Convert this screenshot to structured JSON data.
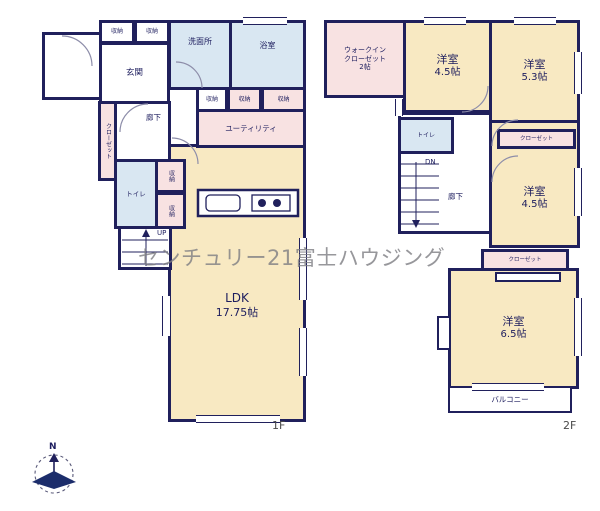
{
  "watermark": "センチュリー21富士ハウジング",
  "compass": {
    "north_label": "N"
  },
  "floor1": {
    "floor_label": "1F",
    "genkan": "玄関",
    "storage_a": "収納",
    "storage_b": "収納",
    "washroom": "洗面所",
    "bathroom": "浴室",
    "storage_c": "収納",
    "storage_d": "収納",
    "storage_e": "収納",
    "utility": "ユーティリティ",
    "closet": "クローゼット",
    "hallway": "廊下",
    "toilet": "トイレ",
    "storage_f": "収納",
    "storage_g": "収納",
    "stairs_up": "UP",
    "ldk_name": "LDK",
    "ldk_size": "17.75帖"
  },
  "floor2": {
    "floor_label": "2F",
    "wic_line1": "ウォークイン",
    "wic_line2": "クローゼット",
    "wic_size": "2帖",
    "room1_name": "洋室",
    "room1_size": "4.5帖",
    "room2_name": "洋室",
    "room2_size": "5.3帖",
    "toilet": "トイレ",
    "stairs_down": "DN",
    "hallway": "廊下",
    "closet1": "クローゼット",
    "room3_name": "洋室",
    "room3_size": "4.5帖",
    "closet2": "クローゼット",
    "room4_name": "洋室",
    "room4_size": "6.5帖",
    "balcony": "バルコニー"
  },
  "colors": {
    "wall": "#20205c",
    "room_cream": "#f8e9c2",
    "room_blue": "#d9e7f2",
    "room_pink": "#f8e2e2",
    "watermark_gray": "#9a9a9a"
  }
}
